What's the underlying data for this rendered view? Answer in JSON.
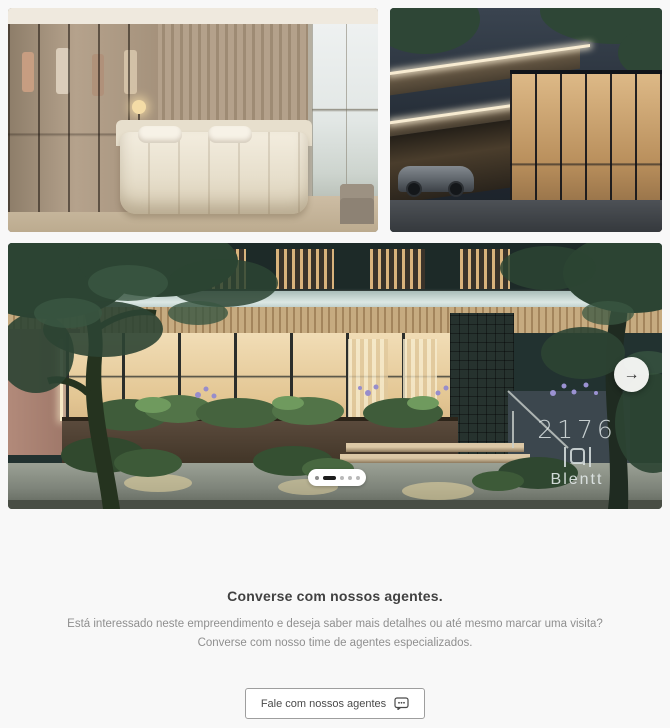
{
  "gallery": {
    "photos": [
      {
        "id": "bedroom",
        "name": "bedroom-interior-photo"
      },
      {
        "id": "exterior",
        "name": "building-exterior-night-photo"
      },
      {
        "id": "facade",
        "name": "building-facade-street-photo"
      }
    ],
    "signage": {
      "number": "2176",
      "brand": "Blentt",
      "logo_icon": "blentt-logo-icon"
    },
    "next_button": {
      "icon": "arrow-right-icon",
      "glyph": "→"
    },
    "dots": {
      "count": 5,
      "active_index": 1
    }
  },
  "cta": {
    "heading": "Converse com nossos agentes.",
    "line1": "Está interessado neste empreendimento e deseja saber mais detalhes ou até mesmo marcar uma visita?",
    "line2": "Converse com nosso time de agentes especializados.",
    "button": {
      "label": "Fale com nossos agentes",
      "icon": "chat-icon"
    }
  },
  "colors": {
    "page_background": "#f8f8f8",
    "heading_text": "#414141",
    "body_text": "#8f8f8f",
    "dot_active": "#1d1d1d",
    "signage_text": "#dee6e6"
  }
}
